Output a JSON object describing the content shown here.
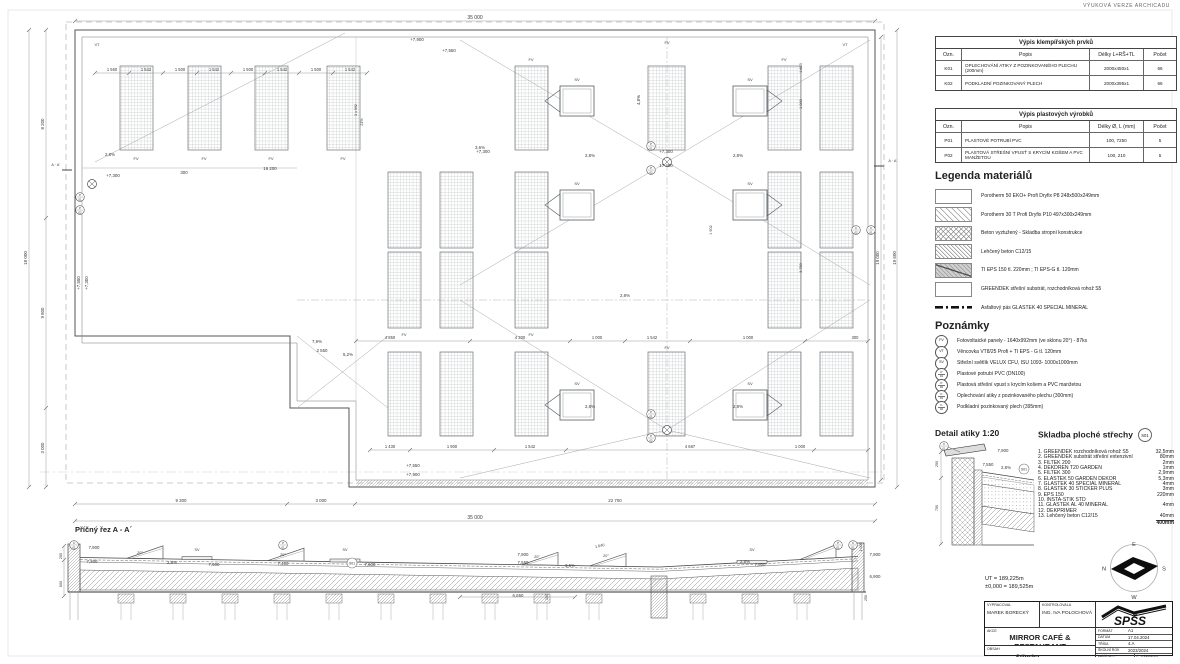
{
  "watermark": "VÝUKOVÁ VERZE ARCHICADU",
  "tables": {
    "klempirske": {
      "title": "Výpis klempířských prvků",
      "headers": [
        "Ozn.",
        "Popis",
        "Délky L+RŠ+TL",
        "Počet"
      ],
      "rows": [
        [
          "K01",
          "OPLECHOVÁNÍ ATIKY Z POZINKOVANÉHO PLECHU (200mm)",
          "2000x450x1",
          "66"
        ],
        [
          "K02",
          "PODKLADNÍ POZINKOVANÝ PLECH",
          "2000x395x1",
          "66"
        ]
      ]
    },
    "plastove": {
      "title": "Výpis plastových výrobků",
      "headers": [
        "Ozn.",
        "Popis",
        "Délky Ø, L (mm)",
        "Počet"
      ],
      "rows": [
        [
          "P01",
          "PLASTOVÉ POTRUBÍ PVC",
          "100, 7250",
          "5"
        ],
        [
          "P02",
          "PLASTOVÁ STŘEŠNÍ VPUSŤ S KRYCÍM KOŠEM A PVC MANŽETOU",
          "100, 210",
          "5"
        ]
      ]
    }
  },
  "legend": {
    "title": "Legenda materiálů",
    "items": [
      {
        "swatch": "blank",
        "label": "Porotherm 50 EKO+ Profi Dryfix P8 248x500x249mm"
      },
      {
        "swatch": "diag",
        "label": "Porotherm 30 T Profi Dryfix P10 497x300x249mm"
      },
      {
        "swatch": "cross",
        "label": "Beton vyztužený - Skladba stropní konstrukce"
      },
      {
        "swatch": "diag2",
        "label": "Lehčený beton C12/15"
      },
      {
        "swatch": "eps",
        "label": "TI EPS 150 tl. 220mm ; TI EPS-G tl. 120mm"
      },
      {
        "swatch": "blank",
        "label": "GREENDEK střešní substrát, rozchodníková rohož S5"
      },
      {
        "swatch": "dashline",
        "label": "Asfaltový pás GLASTEK 40 SPECIAL MINERAL"
      }
    ]
  },
  "notes": {
    "title": "Poznámky",
    "items": [
      {
        "mark": "FV",
        "label": "Fotovoltaické panely - 1640x992mm (ve sklonu 20°) - 87ks"
      },
      {
        "mark": "VT",
        "label": "Věncovka VT8/25 Profi + TI EPS - G tl. 120mm"
      },
      {
        "mark": "SV",
        "label": "Střešní světlík VELUX CFU, ISU 1093- 1000x1000mm"
      },
      {
        "mark": "P|01",
        "label": "Plastové potrubí PVC (DN100)"
      },
      {
        "mark": "P|02",
        "label": "Plastová střešní vpust s krycím košem a PVC manžetou"
      },
      {
        "mark": "K|01",
        "label": "Oplechování atiky z pozinkovaného plechu (300mm)"
      },
      {
        "mark": "K|02",
        "label": "Podkladní pozinkovaný plech (395mm)"
      }
    ]
  },
  "detail": {
    "title": "Detail atiky 1:20",
    "annotations": [
      [
        "K|01",
        944,
        446,
        0,
        4.4,
        1
      ],
      [
        "7,900",
        1003,
        452
      ],
      [
        "7,550",
        988,
        466
      ],
      [
        "2,8%",
        1006,
        469
      ],
      [
        "S01",
        1024,
        469,
        0,
        3.4,
        2
      ],
      [
        "250",
        938,
        464,
        -90,
        3.8
      ],
      [
        "750",
        938,
        508,
        -90,
        3.8
      ]
    ]
  },
  "skladba": {
    "title": "Skladba ploché střechy",
    "badge": "S01",
    "items": [
      {
        "name": "1. GREENDEK rozchodníková rohož S5",
        "value": "32,5mm"
      },
      {
        "name": "2. GREENDEK substrát střešní extenzivní",
        "value": "80mm"
      },
      {
        "name": "3. FILTEK 200",
        "value": "2mm"
      },
      {
        "name": "4. DEKDREN T20 GARDEN",
        "value": "1mm"
      },
      {
        "name": "5. FILTEK 300",
        "value": "2,9mm"
      },
      {
        "name": "6. ELASTEK 50 GARDEN DEKOR",
        "value": "5,3mm"
      },
      {
        "name": "7. GLASTEK 40 SPECIAL MINERAL",
        "value": "4mm"
      },
      {
        "name": "8. GLASTEK 30 STICKER PLUS",
        "value": "3mm"
      },
      {
        "name": "9. EPS 150",
        "value": "220mm"
      },
      {
        "name": "10. INSTA-STIK STD",
        "value": ""
      },
      {
        "name": "11. GLASTEK AL 40 MINERAL",
        "value": "4mm"
      },
      {
        "name": "12. DEKPRIMER",
        "value": ""
      },
      {
        "name": "13. Lehčený beton C12/15",
        "value": "40mm"
      }
    ],
    "total": "400mm"
  },
  "levels": {
    "ut": "UT = 189,225m",
    "zero": "±0,000 = 189,525m"
  },
  "compass": {
    "e": "E",
    "n": "N",
    "s": "S",
    "w": "W"
  },
  "titleblock": {
    "vypracoval_label": "VYPRACOVAL",
    "vypracoval": "MAREK BORECKÝ",
    "kontrolovala_label": "KONTROLOVALA",
    "kontrolovala": "ING. IVA POLOCHOVÁ",
    "akce_label": "AKCE",
    "akce": "MIRROR CAFÉ & RESTAURANT",
    "obsah_label": "OBSAH",
    "obsah": "Střecha",
    "format_label": "FORMÁT",
    "format": "A1",
    "datum_label": "DATUM",
    "datum": "17.04.2024",
    "trida_label": "TŘÍDA",
    "trida": "4.A",
    "rok_label": "ŠKOLNÍ ROK",
    "rok": "2023/2024",
    "meritko_label": "MĚŘÍTKO",
    "meritko": "1:50",
    "cislo_label": "Č. VÝKRESU",
    "cislo": "07",
    "logo": "SPŠS"
  },
  "section": {
    "title": "Příčný řez A - A´",
    "annotations": [
      [
        "K|01",
        74,
        545,
        0,
        4.4,
        1
      ],
      [
        "7,900",
        94,
        549
      ],
      [
        "7,300",
        92,
        563
      ],
      [
        "250",
        62,
        556,
        -90,
        3.8
      ],
      [
        "600",
        62,
        584,
        -90,
        3.8
      ],
      [
        "20°",
        140,
        554,
        0,
        3.8
      ],
      [
        "2,8%",
        172,
        564
      ],
      [
        "SV",
        197,
        551,
        0,
        3.8
      ],
      [
        "7,600",
        214,
        566
      ],
      [
        "20°",
        283,
        556,
        0,
        3.8
      ],
      [
        "P|01",
        283,
        545,
        0,
        4.4,
        1
      ],
      [
        "7,400",
        283,
        565
      ],
      [
        "SV",
        345,
        551,
        0,
        3.8
      ],
      [
        "S01",
        352,
        563,
        0,
        3.4,
        2
      ],
      [
        "7,600",
        370,
        566
      ],
      [
        "7,900",
        523,
        556
      ],
      [
        "7,550",
        523,
        564
      ],
      [
        "20°",
        537,
        558,
        0,
        3.8
      ],
      [
        "3,6%",
        570,
        567
      ],
      [
        "1 640",
        600,
        547,
        -12,
        3.8
      ],
      [
        "20°",
        606,
        557,
        0,
        3.8
      ],
      [
        "2,8%",
        745,
        563
      ],
      [
        "SV",
        752,
        551,
        0,
        3.8
      ],
      [
        "7,600",
        760,
        566
      ],
      [
        "6,650",
        518,
        597
      ],
      [
        "150",
        548,
        597,
        -90,
        3.6
      ],
      [
        "1 000",
        862,
        547,
        -90,
        3.6
      ],
      [
        "P|01",
        838,
        545,
        0,
        4.4,
        1
      ],
      [
        "K|01",
        853,
        545,
        0,
        4.4,
        1
      ],
      [
        "7,900",
        875,
        556
      ],
      [
        "6,900",
        875,
        578
      ],
      [
        "250",
        867,
        598,
        -90,
        3.6
      ]
    ]
  },
  "plan": {
    "annotations": [
      [
        "35 000",
        475,
        19,
        0,
        5
      ],
      [
        "1 560",
        112,
        71,
        0,
        4.1
      ],
      [
        "1 542",
        146,
        71,
        0,
        4.1
      ],
      [
        "1 500",
        180,
        71,
        0,
        4.1
      ],
      [
        "1 542",
        214,
        71,
        0,
        4.1
      ],
      [
        "1 500",
        248,
        71,
        0,
        4.1
      ],
      [
        "1 542",
        282,
        71,
        0,
        4.1
      ],
      [
        "1 500",
        316,
        71,
        0,
        4.1
      ],
      [
        "1 542",
        350,
        71,
        0,
        4.1
      ],
      [
        "VT",
        97,
        46,
        0,
        4
      ],
      [
        "VT",
        845,
        46,
        0,
        4
      ],
      [
        "+7,900",
        417,
        41
      ],
      [
        "+7,550",
        449,
        52
      ],
      [
        "FV",
        136,
        160,
        0,
        4
      ],
      [
        "FV",
        204,
        160,
        0,
        4
      ],
      [
        "FV",
        271,
        160,
        0,
        4
      ],
      [
        "FV",
        343,
        160,
        0,
        4
      ],
      [
        "FV",
        531,
        61,
        0,
        4
      ],
      [
        "FV",
        667,
        44,
        0,
        4
      ],
      [
        "FV",
        784,
        61,
        0,
        4
      ],
      [
        "FV",
        404,
        336,
        0,
        4
      ],
      [
        "FV",
        531,
        336,
        0,
        4
      ],
      [
        "FV",
        667,
        349,
        0,
        4
      ],
      [
        "2,8%",
        110,
        156
      ],
      [
        "2,8%",
        590,
        157
      ],
      [
        "2,8%",
        738,
        157
      ],
      [
        "2,8%",
        625,
        297
      ],
      [
        "2,8%",
        590,
        408
      ],
      [
        "2,8%",
        738,
        408
      ],
      [
        "3,6%",
        480,
        149
      ],
      [
        "4,8%",
        640,
        100,
        -90
      ],
      [
        "+7,300",
        483,
        153
      ],
      [
        "+7,300",
        666,
        153
      ],
      [
        "17 400",
        666,
        167
      ],
      [
        "16 200",
        270,
        170
      ],
      [
        "300",
        184,
        174
      ],
      [
        "+7,300",
        113,
        177
      ],
      [
        "A · A´",
        56,
        166,
        0,
        3.8
      ],
      [
        "A · A´",
        893,
        162,
        0,
        3.8
      ],
      [
        "+7,550",
        80,
        283,
        -90
      ],
      [
        "+7,300",
        88,
        283,
        -90
      ],
      [
        "7,9%",
        317,
        343
      ],
      [
        "2 550",
        322,
        352
      ],
      [
        "5,2%",
        348,
        356
      ],
      [
        "3 x 992",
        357,
        110,
        -90,
        3.6
      ],
      [
        "21%",
        363,
        122,
        -90,
        3.6
      ],
      [
        "1 823",
        802,
        68,
        -90,
        3.8
      ],
      [
        "1 000",
        802,
        104,
        -90,
        3.8
      ],
      [
        "3 750",
        802,
        268,
        -90,
        3.8
      ],
      [
        "1 902",
        712,
        230,
        -90,
        3.8
      ],
      [
        "4 850",
        390,
        339,
        0,
        4.1
      ],
      [
        "4 300",
        520,
        339,
        0,
        4.1
      ],
      [
        "1 000",
        597,
        339,
        0,
        4.1
      ],
      [
        "1 542",
        652,
        339,
        0,
        4.1
      ],
      [
        "1 000",
        748,
        339,
        0,
        4.1
      ],
      [
        "300",
        855,
        339,
        0,
        4.1
      ],
      [
        "+7,550",
        413,
        467
      ],
      [
        "+7,900",
        413,
        476
      ],
      [
        "1 430",
        390,
        448,
        0,
        4.1
      ],
      [
        "1 900",
        452,
        448,
        0,
        4.1
      ],
      [
        "1 542",
        530,
        448,
        0,
        4.1
      ],
      [
        "4 687",
        690,
        448,
        0,
        4.1
      ],
      [
        "1 000",
        800,
        448,
        0,
        4.1
      ],
      [
        "9 300",
        181,
        502
      ],
      [
        "3 000",
        321,
        502
      ],
      [
        "22 700",
        615,
        502
      ],
      [
        "35 000",
        475,
        519,
        0,
        5
      ],
      [
        "18 000",
        27,
        258,
        -90,
        4.5
      ],
      [
        "8 200",
        44,
        124,
        -90
      ],
      [
        "9 800",
        44,
        313,
        -90
      ],
      [
        "3 000",
        44,
        448,
        -90
      ],
      [
        "19 000",
        879,
        258,
        -90
      ],
      [
        "19 600",
        896,
        258,
        -90,
        4.5
      ],
      [
        "SV",
        577,
        81,
        0,
        4
      ],
      [
        "SV",
        750,
        81,
        0,
        4
      ],
      [
        "SV",
        577,
        185,
        0,
        4
      ],
      [
        "SV",
        750,
        185,
        0,
        4
      ],
      [
        "SV",
        577,
        385,
        0,
        4
      ],
      [
        "SV",
        750,
        385,
        0,
        4
      ],
      [
        "K|02",
        856,
        230,
        0,
        4.4,
        1
      ],
      [
        "K|01",
        871,
        230,
        0,
        4.4,
        1
      ],
      [
        "P|01",
        651,
        146,
        0,
        4.4,
        1
      ],
      [
        "P|02",
        651,
        170,
        0,
        4.4,
        1
      ],
      [
        "P|01",
        80,
        197,
        0,
        4.4,
        1
      ],
      [
        "P|02",
        80,
        210,
        0,
        4.4,
        1
      ],
      [
        "P|01",
        651,
        414,
        0,
        4.4,
        1
      ],
      [
        "P|02",
        651,
        438,
        0,
        4.4,
        1
      ]
    ]
  }
}
